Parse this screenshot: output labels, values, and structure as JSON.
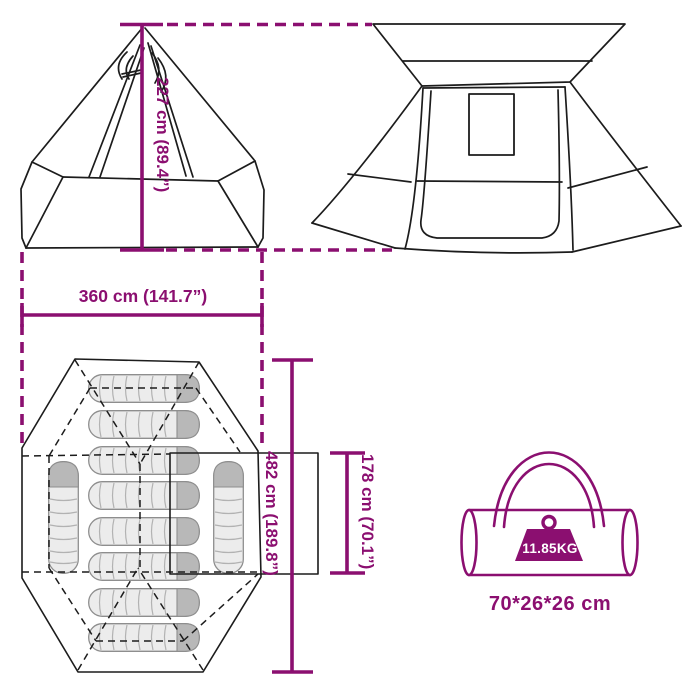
{
  "colors": {
    "accent_magenta": "#8B0F70",
    "line_black": "#1C1C1C",
    "bag_fill": "#ECECEC",
    "bag_cap": "#B8B8B8",
    "bag_stroke": "#8E8E8E",
    "weight_label_text": "#FFFFFF"
  },
  "views": {
    "side_view": {
      "description": "tipi tent side elevation",
      "height_label": "227 cm (89.4”)",
      "width_label": "360 cm (141.7”)"
    },
    "front_view": {
      "description": "tent front elevation with door and window"
    },
    "floor_plan": {
      "description": "octagonal floor plan with sleeping bags and vestibule",
      "length_label": "482 cm (189.8”)",
      "vestibule_depth_label": "178 cm (70.1”)",
      "sleeping_bags_horizontal_count": 8,
      "sleeping_bags_vertical_count": 2
    },
    "carry_bag": {
      "description": "packed tent carry bag",
      "weight_label": "11.85KG",
      "size_label": "70*26*26 cm"
    }
  }
}
